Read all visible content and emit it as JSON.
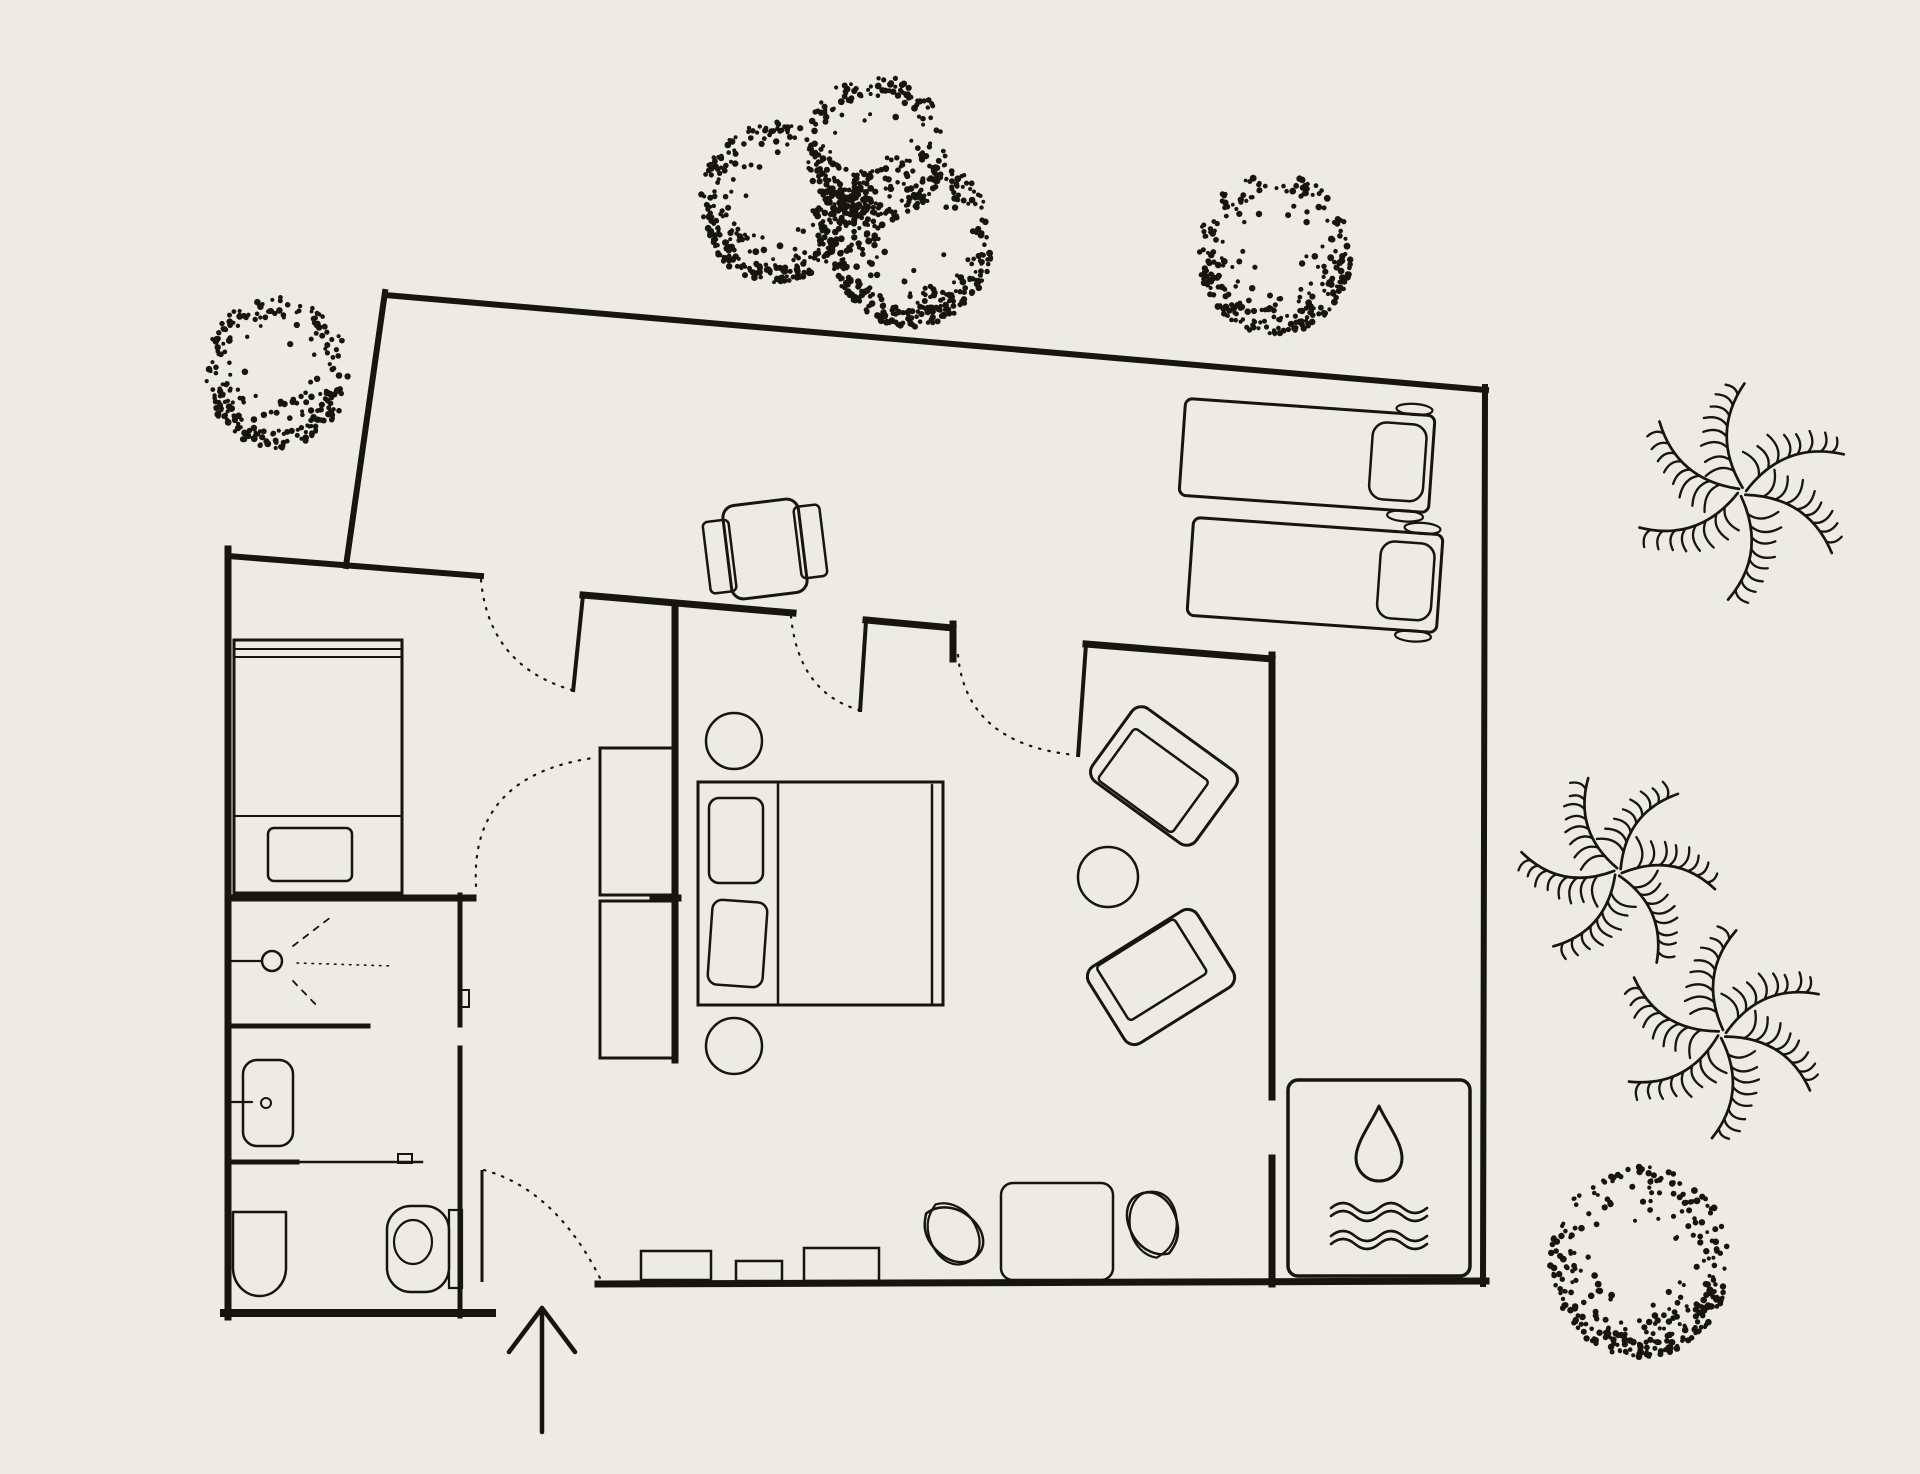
{
  "canvas": {
    "width": 1920,
    "height": 1474,
    "background": "#ecebe5",
    "ink": "#17150f"
  },
  "plan": {
    "walls": [
      {
        "name": "deck-edge-top",
        "x1": 385,
        "y1": 295,
        "x2": 1486,
        "y2": 390,
        "w": 6
      },
      {
        "name": "deck-edge-right",
        "x1": 1485,
        "y1": 387,
        "x2": 1483,
        "y2": 1284,
        "w": 6
      },
      {
        "name": "deck-edge-left",
        "x1": 385,
        "y1": 292,
        "x2": 346,
        "y2": 566,
        "w": 6
      },
      {
        "name": "bath-wall-left",
        "x1": 228,
        "y1": 549,
        "x2": 228,
        "y2": 1317,
        "w": 7
      },
      {
        "name": "bath-wall-top",
        "x1": 228,
        "y1": 556,
        "x2": 481,
        "y2": 576,
        "w": 6
      },
      {
        "name": "bath-wall-bottom",
        "x1": 224,
        "y1": 1313,
        "x2": 492,
        "y2": 1313,
        "w": 8
      },
      {
        "name": "corridor-wall-top",
        "x1": 583,
        "y1": 595,
        "x2": 793,
        "y2": 613,
        "w": 7
      },
      {
        "name": "bedroom-wall-top",
        "x1": 866,
        "y1": 620,
        "x2": 953,
        "y2": 628,
        "w": 7
      },
      {
        "name": "door3-jamb",
        "x1": 953,
        "y1": 624,
        "x2": 953,
        "y2": 659,
        "w": 7
      },
      {
        "name": "living-wall-top",
        "x1": 1086,
        "y1": 644,
        "x2": 1272,
        "y2": 659,
        "w": 7
      },
      {
        "name": "living-wall-right-upper",
        "x1": 1272,
        "y1": 655,
        "x2": 1272,
        "y2": 1097,
        "w": 7
      },
      {
        "name": "living-wall-right-lower",
        "x1": 1272,
        "y1": 1158,
        "x2": 1272,
        "y2": 1284,
        "w": 7
      },
      {
        "name": "wall-bottom-main",
        "x1": 598,
        "y1": 1284,
        "x2": 1486,
        "y2": 1281,
        "w": 7
      },
      {
        "name": "shower-wall-top",
        "x1": 228,
        "y1": 898,
        "x2": 473,
        "y2": 898,
        "w": 7
      },
      {
        "name": "shower-wall-top-stub",
        "x1": 653,
        "y1": 898,
        "x2": 678,
        "y2": 898,
        "w": 7
      },
      {
        "name": "corridor-wall-inner",
        "x1": 675,
        "y1": 605,
        "x2": 675,
        "y2": 1060,
        "w": 7
      },
      {
        "name": "bath-wall-right-upper",
        "x1": 460,
        "y1": 895,
        "x2": 460,
        "y2": 1025,
        "w": 5
      },
      {
        "name": "bath-wall-right-lower",
        "x1": 460,
        "y1": 1048,
        "x2": 460,
        "y2": 1316,
        "w": 5
      },
      {
        "name": "divider-shower-sink",
        "x1": 228,
        "y1": 1026,
        "x2": 368,
        "y2": 1026,
        "w": 5
      },
      {
        "name": "divider-sink-wc-thick",
        "x1": 228,
        "y1": 1162,
        "x2": 297,
        "y2": 1162,
        "w": 5
      },
      {
        "name": "divider-sink-wc-thin",
        "x1": 297,
        "y1": 1162,
        "x2": 422,
        "y2": 1162,
        "w": 2.5
      }
    ],
    "door_leaves": [
      {
        "name": "door1-leaf",
        "x1": 583,
        "y1": 595,
        "x2": 573,
        "y2": 692,
        "w": 4
      },
      {
        "name": "door2-leaf",
        "x1": 866,
        "y1": 621,
        "x2": 860,
        "y2": 712,
        "w": 4
      },
      {
        "name": "door3-leaf",
        "x1": 1086,
        "y1": 644,
        "x2": 1078,
        "y2": 757,
        "w": 4
      },
      {
        "name": "entry-door-leaf",
        "x1": 482,
        "y1": 1170,
        "x2": 482,
        "y2": 1282,
        "w": 3
      }
    ],
    "door_arcs": [
      {
        "name": "door1-swing-arc",
        "d": "M481,580 Q489,666 572,690"
      },
      {
        "name": "door2-swing-arc",
        "d": "M791,616 Q798,692 859,710"
      },
      {
        "name": "door3-swing-arc",
        "d": "M958,655 Q966,744 1075,755"
      },
      {
        "name": "closet-door-swing-arc",
        "d": "M476,886 Q470,776 593,758"
      },
      {
        "name": "entry-door-swing-arc",
        "d": "M484,1170 Q556,1190 601,1280"
      }
    ],
    "details": [
      {
        "name": "shower-door-hinge-tick",
        "type": "rect",
        "x": 460,
        "y": 990,
        "w": 9,
        "h": 17,
        "sw": 2
      },
      {
        "name": "wc-divider-tick",
        "type": "rect",
        "x": 398,
        "y": 1154,
        "w": 14,
        "h": 9,
        "sw": 2
      },
      {
        "name": "shower-arm",
        "type": "line",
        "x1": 230,
        "y1": 961,
        "x2": 261,
        "y2": 961,
        "sw": 2.2
      },
      {
        "name": "sink-arm",
        "type": "line",
        "x1": 232,
        "y1": 1102,
        "x2": 252,
        "y2": 1102,
        "sw": 2.2
      }
    ],
    "bathroom": [
      {
        "name": "shower-head",
        "type": "circle",
        "cx": 272,
        "cy": 961,
        "r": 10,
        "sw": 2.5
      },
      {
        "name": "shower-spray-mid",
        "type": "line",
        "x1": 297,
        "y1": 963,
        "x2": 393,
        "y2": 966,
        "sw": 1.6,
        "dash": "1.5 6"
      },
      {
        "name": "shower-spray-up",
        "type": "line",
        "x1": 293,
        "y1": 946,
        "x2": 331,
        "y2": 917,
        "sw": 1.8,
        "dash": "6 7"
      },
      {
        "name": "shower-spray-down",
        "type": "line",
        "x1": 293,
        "y1": 981,
        "x2": 320,
        "y2": 1009,
        "sw": 1.8,
        "dash": "6 7"
      },
      {
        "name": "sink-basin",
        "type": "rect",
        "x": 243,
        "y": 1060,
        "w": 50,
        "h": 86,
        "r": 14,
        "sw": 2.5
      },
      {
        "name": "sink-drain",
        "type": "circle",
        "cx": 266,
        "cy": 1103,
        "r": 5,
        "sw": 2
      },
      {
        "name": "toilet-bowl-left",
        "type": "path",
        "d": "M233,1212 h53 v56 a26.5,28 0 0 1 -53,0 Z",
        "sw": 2.5
      },
      {
        "name": "toilet-right-shell",
        "type": "rect",
        "x": 387,
        "y": 1206,
        "w": 62,
        "h": 86,
        "r": 24,
        "sw": 2.5
      },
      {
        "name": "toilet-right-bowl",
        "type": "ellipse",
        "cx": 413,
        "cy": 1242,
        "rx": 19,
        "ry": 22,
        "sw": 2.2
      },
      {
        "name": "toilet-right-tank",
        "type": "rect",
        "x": 449,
        "y": 1210,
        "w": 13,
        "h": 78,
        "sw": 2.2
      }
    ],
    "storage": [
      {
        "name": "entry-closet-box",
        "type": "rect",
        "x": 234,
        "y": 640,
        "w": 168,
        "h": 253,
        "sw": 3
      },
      {
        "name": "entry-closet-rail-1",
        "type": "line",
        "x1": 234,
        "y1": 649,
        "x2": 402,
        "y2": 649,
        "sw": 2
      },
      {
        "name": "entry-closet-rail-2",
        "type": "line",
        "x1": 234,
        "y1": 657,
        "x2": 402,
        "y2": 657,
        "sw": 2
      },
      {
        "name": "entry-closet-shelf",
        "type": "line",
        "x1": 234,
        "y1": 816,
        "x2": 402,
        "y2": 816,
        "sw": 2
      },
      {
        "name": "closet-tv-unit",
        "type": "rect",
        "x": 268,
        "y": 828,
        "w": 84,
        "h": 53,
        "r": 6,
        "sw": 2.5
      },
      {
        "name": "corridor-wardrobe-upper",
        "type": "rect",
        "x": 600,
        "y": 748,
        "w": 73,
        "h": 147,
        "sw": 3
      },
      {
        "name": "corridor-wardrobe-lower",
        "type": "rect",
        "x": 600,
        "y": 901,
        "w": 73,
        "h": 157,
        "sw": 3
      }
    ],
    "bedroom": [
      {
        "name": "bed-frame",
        "type": "rect",
        "x": 698,
        "y": 782,
        "w": 245,
        "h": 223,
        "sw": 3
      },
      {
        "name": "bed-headboard-line",
        "type": "line",
        "x1": 778,
        "y1": 782,
        "x2": 778,
        "y2": 1005,
        "sw": 2.5
      },
      {
        "name": "bed-foot-band",
        "type": "line",
        "x1": 932,
        "y1": 785,
        "x2": 932,
        "y2": 1003,
        "sw": 2.5
      },
      {
        "name": "bed-pillow-1",
        "type": "rect",
        "x": 709,
        "y": 798,
        "w": 54,
        "h": 85,
        "r": 10,
        "sw": 2.5
      },
      {
        "name": "bed-pillow-2",
        "type": "rect",
        "x": 710,
        "y": 901,
        "w": 55,
        "h": 85,
        "r": 10,
        "sw": 2.5,
        "rot": 4
      },
      {
        "name": "nightstand-top",
        "type": "circle",
        "cx": 734,
        "cy": 741,
        "r": 28,
        "sw": 2.5
      },
      {
        "name": "nightstand-bottom",
        "type": "circle",
        "cx": 734,
        "cy": 1046,
        "r": 28,
        "sw": 2.5
      }
    ],
    "living": [
      {
        "name": "armchair-1",
        "type": "g",
        "rot": 36,
        "cx": 1164,
        "cy": 776,
        "items": [
          {
            "name": "armchair-1-shell",
            "type": "rect",
            "x": 1100,
            "y": 731,
            "w": 128,
            "h": 90,
            "r": 12,
            "sw": 3
          },
          {
            "name": "armchair-1-cushion",
            "type": "rect",
            "x": 1112,
            "y": 754,
            "w": 92,
            "h": 64,
            "r": 4,
            "sw": 2.5
          }
        ]
      },
      {
        "name": "armchair-2",
        "type": "g",
        "rot": -32,
        "cx": 1161,
        "cy": 977,
        "items": [
          {
            "name": "armchair-2-shell",
            "type": "rect",
            "x": 1097,
            "y": 932,
            "w": 128,
            "h": 90,
            "r": 12,
            "sw": 3
          },
          {
            "name": "armchair-2-cushion",
            "type": "rect",
            "x": 1111,
            "y": 934,
            "w": 92,
            "h": 64,
            "r": 4,
            "sw": 2.5
          }
        ]
      },
      {
        "name": "side-table",
        "type": "circle",
        "cx": 1108,
        "cy": 877,
        "r": 30,
        "sw": 2.5
      },
      {
        "name": "console-1",
        "type": "rect",
        "x": 641,
        "y": 1251,
        "w": 70,
        "h": 29,
        "sw": 2.5
      },
      {
        "name": "console-2",
        "type": "rect",
        "x": 736,
        "y": 1261,
        "w": 46,
        "h": 20,
        "sw": 2.5
      },
      {
        "name": "console-3",
        "type": "rect",
        "x": 804,
        "y": 1248,
        "w": 75,
        "h": 33,
        "sw": 2.5
      },
      {
        "name": "ottoman-table",
        "type": "rect",
        "x": 1001,
        "y": 1183,
        "w": 112,
        "h": 97,
        "r": 12,
        "sw": 2.5
      },
      {
        "name": "pouf-1",
        "type": "petal",
        "cx": 954,
        "cy": 1233,
        "s": 1.0,
        "rot": -55
      },
      {
        "name": "pouf-2",
        "type": "petal",
        "cx": 1152,
        "cy": 1224,
        "s": 1.0,
        "rot": 150
      }
    ],
    "deck": [
      {
        "name": "deck-armchair",
        "type": "g",
        "rot": -7,
        "cx": 765,
        "cy": 549,
        "items": [
          {
            "name": "deck-armchair-arm-left",
            "type": "rect",
            "x": 706,
            "y": 515,
            "w": 26,
            "h": 72,
            "r": 5,
            "sw": 2.5
          },
          {
            "name": "deck-armchair-arm-right",
            "type": "rect",
            "x": 798,
            "y": 511,
            "w": 26,
            "h": 72,
            "r": 5,
            "sw": 2.5
          },
          {
            "name": "deck-armchair-seat",
            "type": "rect",
            "x": 727,
            "y": 502,
            "w": 76,
            "h": 94,
            "r": 12,
            "sw": 3
          }
        ]
      },
      {
        "name": "sun-lounger-1",
        "type": "g",
        "rot": 4,
        "cx": 1307,
        "cy": 456,
        "items": [
          {
            "name": "lounger-1-body",
            "type": "rect",
            "x": 1182,
            "y": 407,
            "w": 250,
            "h": 97,
            "r": 7,
            "sw": 3
          },
          {
            "name": "lounger-1-pillow",
            "type": "rect",
            "x": 1371,
            "y": 417,
            "w": 54,
            "h": 77,
            "r": 14,
            "sw": 2.5
          },
          {
            "name": "lounger-1-wheel-top",
            "type": "ellipse",
            "cx": 1411,
            "cy": 402,
            "rx": 18,
            "ry": 5.5,
            "sw": 2.2
          },
          {
            "name": "lounger-1-wheel-bottom",
            "type": "ellipse",
            "cx": 1409,
            "cy": 509,
            "rx": 18,
            "ry": 5.5,
            "sw": 2.2
          }
        ]
      },
      {
        "name": "sun-lounger-2",
        "type": "g",
        "rot": 4,
        "cx": 1315,
        "cy": 575,
        "items": [
          {
            "name": "lounger-2-body",
            "type": "rect",
            "x": 1190,
            "y": 526,
            "w": 250,
            "h": 98,
            "r": 7,
            "sw": 3
          },
          {
            "name": "lounger-2-pillow",
            "type": "rect",
            "x": 1379,
            "y": 536,
            "w": 54,
            "h": 77,
            "r": 14,
            "sw": 2.5
          },
          {
            "name": "lounger-2-wheel-top",
            "type": "ellipse",
            "cx": 1419,
            "cy": 521,
            "rx": 18,
            "ry": 5.5,
            "sw": 2.2
          },
          {
            "name": "lounger-2-wheel-bottom",
            "type": "ellipse",
            "cx": 1417,
            "cy": 629,
            "rx": 18,
            "ry": 5.5,
            "sw": 2.2
          }
        ]
      }
    ],
    "pool": [
      {
        "name": "pool-box",
        "type": "rect",
        "x": 1288,
        "y": 1080,
        "w": 182,
        "h": 196,
        "r": 10,
        "sw": 3.5
      },
      {
        "name": "water-drop-icon",
        "type": "path",
        "d": "M1379,1106 C1372,1122 1356,1142 1356,1158 A23,23 0 0 0 1402,1158 C1402,1142 1386,1122 1379,1106 Z",
        "sw": 3
      },
      {
        "name": "wave-icon-1a",
        "type": "path",
        "d": "M1331,1208 q12,-10 24,0 t24,0 t24,0 t24,0",
        "sw": 2.6
      },
      {
        "name": "wave-icon-1b",
        "type": "path",
        "d": "M1331,1216 q12,-10 24,0 t24,0 t24,0 t24,0",
        "sw": 2.6
      },
      {
        "name": "wave-icon-2a",
        "type": "path",
        "d": "M1331,1236 q12,-10 24,0 t24,0 t24,0 t24,0",
        "sw": 2.6
      },
      {
        "name": "wave-icon-2b",
        "type": "path",
        "d": "M1331,1244 q12,-10 24,0 t24,0 t24,0 t24,0",
        "sw": 2.6
      }
    ],
    "entry_arrow": {
      "name": "entry-arrow",
      "shaft": {
        "x1": 542,
        "y1": 1308,
        "x2": 542,
        "y2": 1432,
        "w": 4.5
      },
      "head": {
        "d": "M509,1352 L542,1308 L575,1352",
        "w": 4.5
      }
    },
    "vegetation": {
      "trees": [
        {
          "name": "tree-northwest",
          "cx": 277,
          "cy": 372,
          "R": 72,
          "seed": 11,
          "n": 210,
          "nb": 70
        },
        {
          "name": "tree-cluster-left",
          "cx": 775,
          "cy": 202,
          "R": 76,
          "seed": 21,
          "n": 230,
          "nb": 80
        },
        {
          "name": "tree-cluster-top",
          "cx": 876,
          "cy": 148,
          "R": 70,
          "seed": 31,
          "n": 200,
          "nb": 60
        },
        {
          "name": "tree-cluster-right",
          "cx": 911,
          "cy": 240,
          "R": 82,
          "seed": 41,
          "n": 240,
          "nb": 85
        },
        {
          "name": "tree-northeast",
          "cx": 1275,
          "cy": 253,
          "R": 77,
          "seed": 51,
          "n": 225,
          "nb": 75
        },
        {
          "name": "tree-southeast",
          "cx": 1640,
          "cy": 1262,
          "R": 90,
          "seed": 61,
          "n": 250,
          "nb": 90
        }
      ],
      "clumps": [
        {
          "name": "tree-cluster-core",
          "cx": 852,
          "cy": 220,
          "R": 38,
          "seed": 71,
          "n": 70
        }
      ],
      "palms": [
        {
          "name": "palm-tree-1",
          "cx": 1742,
          "cy": 492,
          "R": 108,
          "rot": -18,
          "seed": 81
        },
        {
          "name": "palm-tree-2",
          "cx": 1618,
          "cy": 872,
          "R": 98,
          "rot": 14,
          "seed": 91
        },
        {
          "name": "palm-tree-3",
          "cx": 1722,
          "cy": 1034,
          "R": 104,
          "rot": 42,
          "seed": 101
        }
      ]
    }
  }
}
